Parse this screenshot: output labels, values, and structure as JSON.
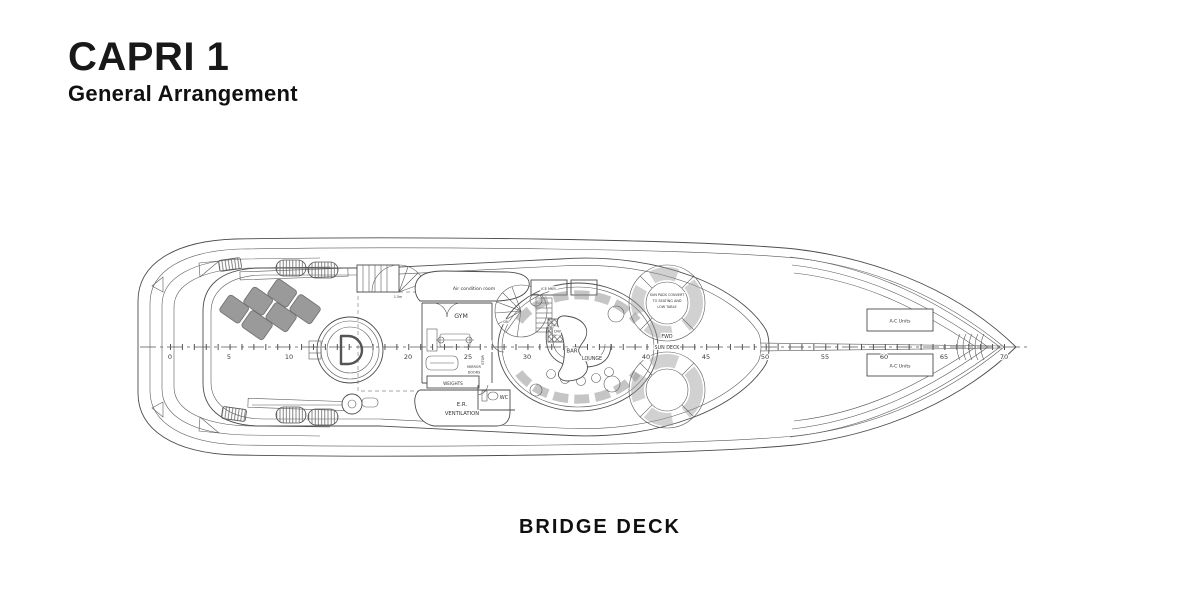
{
  "header": {
    "title": "CAPRI 1",
    "subtitle": "General Arrangement"
  },
  "footer": {
    "deck_label": "BRIDGE DECK"
  },
  "plan": {
    "labels": {
      "air_condition_room": "Air condition room",
      "gym": "GYM",
      "stor": "STOR",
      "mirror_line1": "MIRROR",
      "mirror_line2": "DOORS",
      "weights": "WEIGHTS",
      "er_line1": "E.R.",
      "er_line2": "VENTILATION",
      "wc": "WC",
      "ice_maker": "ICE MKR.",
      "dumbwaiter": "DW",
      "bar": "BAR",
      "lounge": "LOUNGE",
      "stair_down": "DN",
      "stair_note": "1.5m",
      "sun_pads_line1": "SUN PADS CONVERT",
      "sun_pads_line2": "TO SEATING AND",
      "sun_pads_line3": "LOW TABLE",
      "fwd": "FWD",
      "sun_deck": "SUN DECK",
      "ac_units_fwd_top": "A-C Units",
      "ac_units_fwd_bottom": "A-C Units"
    },
    "scale_ticks": [
      "0",
      "5",
      "10",
      "20",
      "25",
      "30",
      "40",
      "45",
      "50",
      "55",
      "60",
      "65",
      "70"
    ]
  }
}
